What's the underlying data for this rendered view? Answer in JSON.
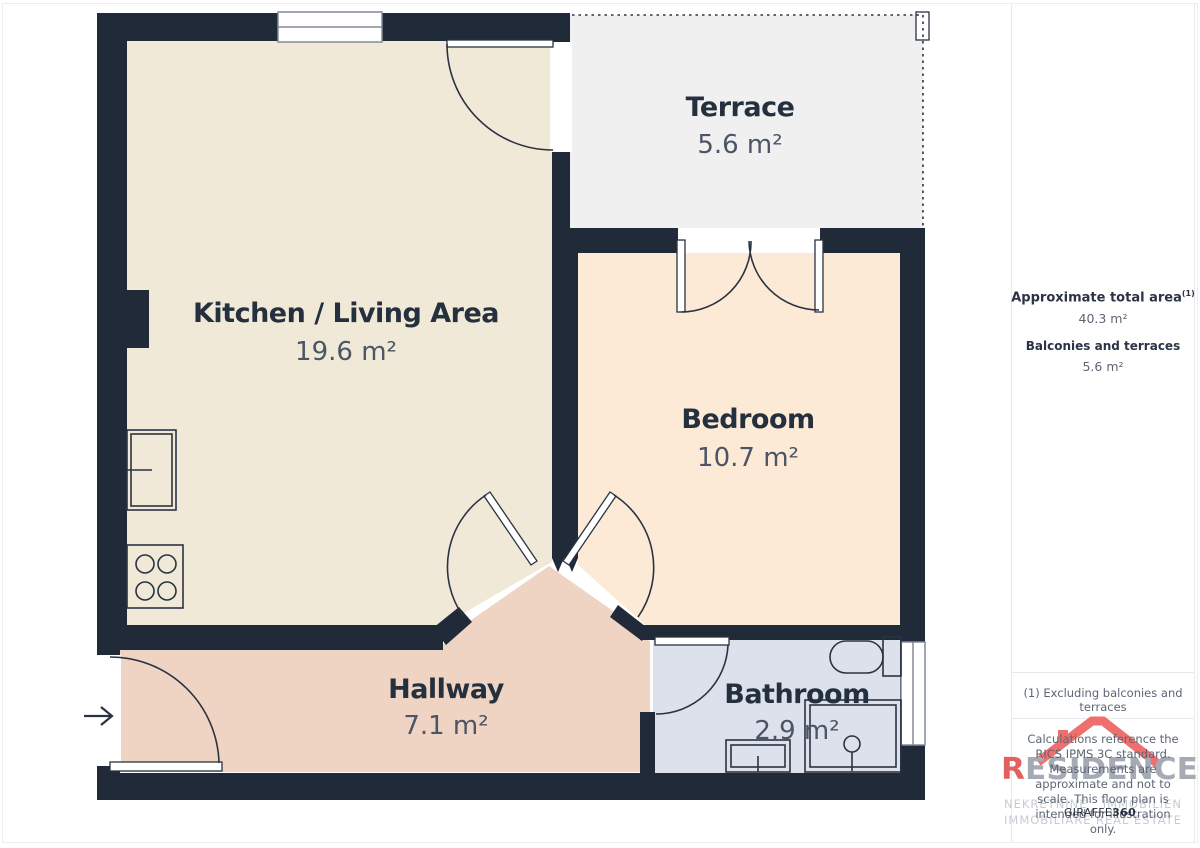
{
  "plan": {
    "rooms": [
      {
        "id": "kitchen-living",
        "name": "Kitchen / Living Area",
        "area": "19.6 m²"
      },
      {
        "id": "terrace",
        "name": "Terrace",
        "area": "5.6 m²"
      },
      {
        "id": "bedroom",
        "name": "Bedroom",
        "area": "10.7 m²"
      },
      {
        "id": "hallway",
        "name": "Hallway",
        "area": "7.1 m²"
      },
      {
        "id": "bathroom",
        "name": "Bathroom",
        "area": "2.9 m²"
      }
    ]
  },
  "sidebar": {
    "total_area_label": "Approximate total area",
    "total_area_footnote_ref": "(1)",
    "total_area_value": "40.3 m²",
    "balconies_label": "Balconies and terraces",
    "balconies_value": "5.6 m²",
    "footnote": "(1) Excluding balconies and terraces",
    "disclaimer": "Calculations reference the RICS IPMS 3C standard. Measurements are approximate and not to scale. This floor plan is intended for illustration only."
  },
  "branding": {
    "logo_first_letter": "R",
    "logo_rest": "ESIDENCE",
    "tagline_words": [
      "NEKRETNINE",
      "IMMOBILIEN",
      "IMMOBILIARE",
      "REAL ESTATE"
    ],
    "provider": "GIRAFFE",
    "provider_suffix": "360"
  },
  "colors": {
    "wall": "#202a38",
    "kitchen_fill": "#f0e9d8",
    "bedroom_fill": "#fcead7",
    "hallway_fill": "#efd3c3",
    "bathroom_fill": "#dde1ec",
    "terrace_fill": "#f0f0f1",
    "label_dark": "#25303e",
    "label_gray": "#4b5565",
    "accent_red": "#e2615f",
    "roof_red": "#ee6f6d"
  }
}
